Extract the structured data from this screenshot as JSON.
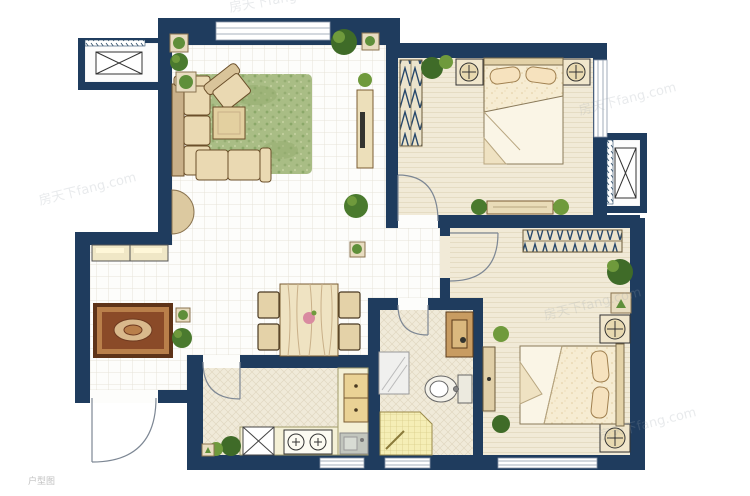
{
  "image": {
    "kind": "residential floor plan drawing",
    "width": 750,
    "height": 496,
    "orientation": "top-down plan view"
  },
  "watermarks": {
    "brand": "房天下fang.com",
    "caption": "户型图"
  },
  "palette": {
    "wall": "#1f3c5e",
    "tile_floor": "#fdfdfb",
    "bedroom_floor": "#f1ead7",
    "kitchen_bath_floor": "#f0ead9",
    "counter": "#f4f0d6",
    "wood": "#e8d7b0",
    "rug_green": "#a9bd85",
    "rug_entry": "#8a4a28",
    "plant_dark": "#3f6b28",
    "plant_light": "#6f9a3c",
    "shower": "#f5eeb6",
    "bed_linen": "#f6ecd2"
  },
  "floorplan": {
    "rooms": [
      {
        "name": "living-room",
        "furniture": [
          "l-shaped-sofa",
          "armchair",
          "coffee-table",
          "green-area-rug",
          "tv-cabinet",
          "side-tables",
          "console-table",
          "potted-plants"
        ]
      },
      {
        "name": "dining-area",
        "furniture": [
          "dining-table-with-runner",
          "four-chairs",
          "flower-centerpiece"
        ]
      },
      {
        "name": "entry-hall",
        "furniture": [
          "shoe-cabinet",
          "ornate-rug",
          "potted-plants",
          "outward-swinging-entry-door"
        ]
      },
      {
        "name": "kitchen",
        "furniture": [
          "two-burner-stove",
          "sink",
          "l-shaped-counter",
          "drawer-unit",
          "appliance-platform",
          "potted-plants"
        ]
      },
      {
        "name": "bathroom",
        "furniture": [
          "vanity-with-mirror",
          "washbasin-cabinet",
          "toilet",
          "corner-shower"
        ]
      },
      {
        "name": "bedroom-1",
        "furniture": [
          "double-bed",
          "two-nightstands-with-lamps",
          "wardrobe",
          "low-dresser",
          "potted-plants"
        ]
      },
      {
        "name": "bedroom-2",
        "furniture": [
          "double-bed",
          "two-nightstands-with-lamps",
          "wardrobe",
          "dresser",
          "potted-plants"
        ]
      },
      {
        "name": "ac-platform-west",
        "furniture": [
          "outdoor-unit"
        ]
      },
      {
        "name": "ac-platform-east",
        "furniture": [
          "outdoor-unit"
        ]
      }
    ],
    "window_count": 6,
    "door_count": 5
  }
}
